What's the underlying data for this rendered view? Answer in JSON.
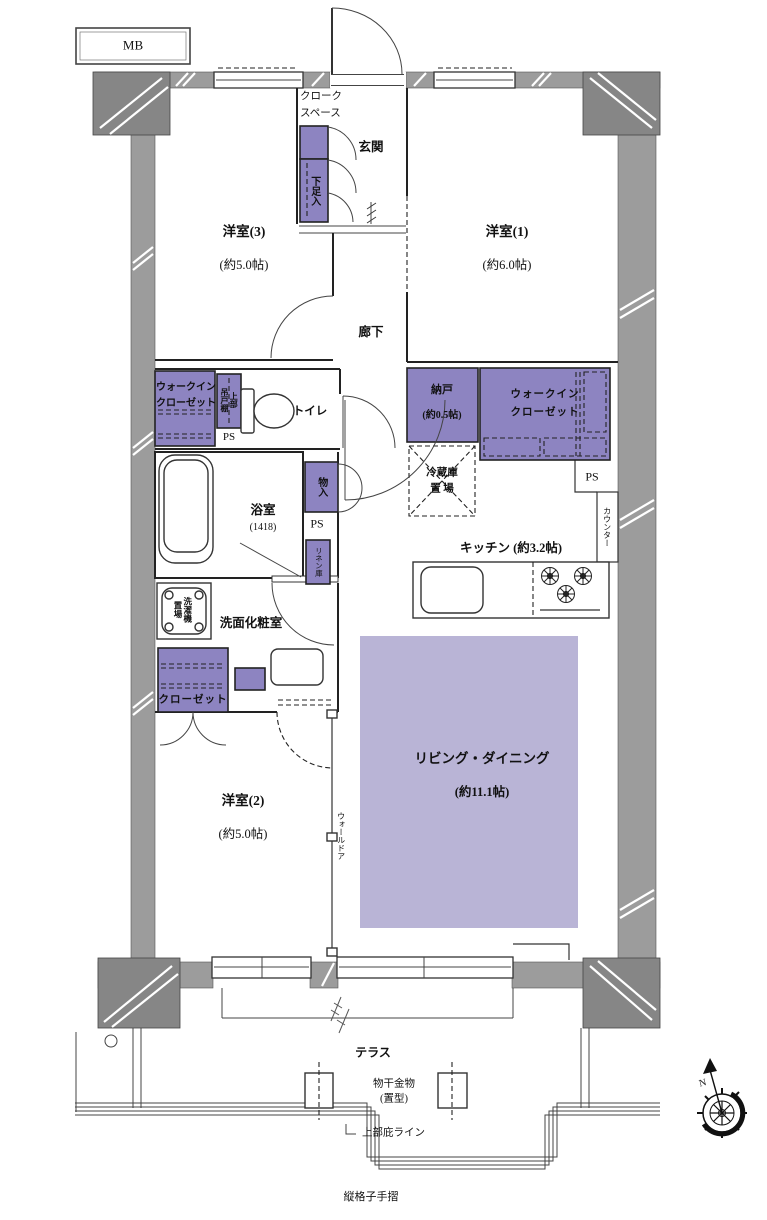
{
  "plan": {
    "mb": "MB",
    "rooms": {
      "western1": {
        "name": "洋室(1)",
        "area": "(約6.0帖)"
      },
      "western2": {
        "name": "洋室(2)",
        "area": "(約5.0帖)"
      },
      "western3": {
        "name": "洋室(3)",
        "area": "(約5.0帖)"
      },
      "living": {
        "name": "リビング・ダイニング",
        "area": "(約11.1帖)"
      },
      "kitchen": {
        "name": "キッチン (約3.2帖)"
      },
      "storage_room": {
        "name": "納戸",
        "area": "(約0.5帖)"
      },
      "bath": {
        "name": "浴室",
        "size": "(1418)"
      },
      "washroom": {
        "name": "洗面化粧室"
      },
      "toilet": {
        "name": "トイレ"
      },
      "entrance": {
        "name": "玄関"
      },
      "hall": {
        "name": "廊下"
      },
      "terrace": {
        "name": "テラス"
      }
    },
    "storage": {
      "cloak": "クローク\nスペース",
      "shoe": "下足入",
      "wic_left": "ウォークイン\nクローゼット",
      "wic_right": "ウォークイン\nクローゼット",
      "upper_shelf": "上部\n吊戸棚",
      "storage_in": "物入",
      "linen": "リネン庫",
      "closet": "クローゼット",
      "fridge_space": "冷蔵庫\n置 場",
      "washer_space": "洗濯機\n置場",
      "counter": "カウンター",
      "wall_door": "ウォールドア",
      "ps": "PS"
    },
    "terrace_items": {
      "drying": "物干金物\n(置型)",
      "eaves": "上部庇ライン",
      "handrail": "縦格子手摺"
    },
    "compass_n": "N",
    "colors": {
      "storage": "#8d84c1",
      "living": "#b9b4d6",
      "wall": "#9c9c9c",
      "pillar": "#868686"
    }
  }
}
